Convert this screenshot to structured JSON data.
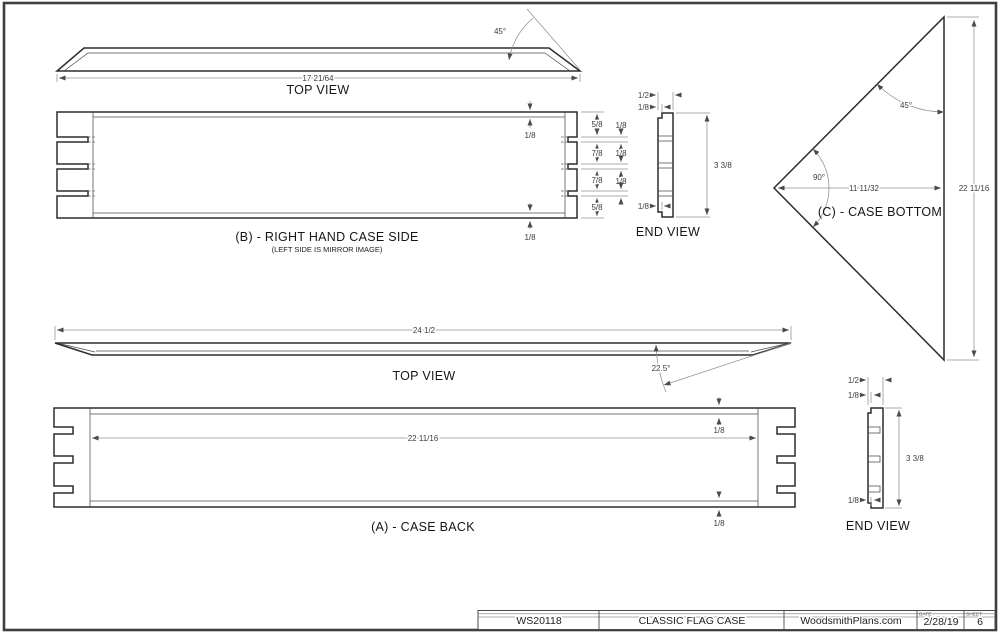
{
  "colors": {
    "outline": "#2d2d2d",
    "dimension": "#8f8f8f",
    "text": "#2b2b2b",
    "border": "#3f3f3f"
  },
  "views": {
    "top_view_b": {
      "label": "TOP VIEW",
      "dim_width": "17 21/64",
      "dim_angle": "45°"
    },
    "case_side_b": {
      "label": "(B) - RIGHT HAND CASE SIDE",
      "sublabel": "(LEFT SIDE IS MIRROR IMAGE)",
      "dim_top_rabbet": "1/8",
      "dim_bottom_rabbet": "1/8",
      "dim_segments": [
        "5/8",
        "7/8",
        "7/8",
        "5/8"
      ],
      "dim_slots": [
        "1/8",
        "1/8",
        "1/8"
      ]
    },
    "end_view_b": {
      "label": "END VIEW",
      "dim_thickness": "1/2",
      "dim_top_rabbet": "1/8",
      "dim_height": "3 3/8",
      "dim_bottom_rabbet": "1/8"
    },
    "case_bottom_c": {
      "label": "(C) - CASE BOTTOM",
      "dim_angle_top": "45°",
      "dim_angle_corner": "90°",
      "dim_depth": "11 11/32",
      "dim_width": "22 11/16"
    },
    "top_view_a": {
      "label": "TOP VIEW",
      "dim_width": "24 1/2",
      "dim_angle": "22.5°"
    },
    "case_back_a": {
      "label": "(A) - CASE BACK",
      "dim_inner_width": "22 11/16",
      "dim_top_rabbet": "1/8",
      "dim_bottom_rabbet": "1/8"
    },
    "end_view_a": {
      "label": "END VIEW",
      "dim_thickness": "1/2",
      "dim_top_rabbet": "1/8",
      "dim_height": "3 3/8",
      "dim_bottom_rabbet": "1/8"
    }
  },
  "title_block": {
    "plan_number": "WS20118",
    "plan_title": "CLASSIC FLAG CASE",
    "website": "WoodsmithPlans.com",
    "date_label": "DATE",
    "date_value": "2/28/19",
    "sheet_label": "SHEET",
    "sheet_value": "6"
  }
}
